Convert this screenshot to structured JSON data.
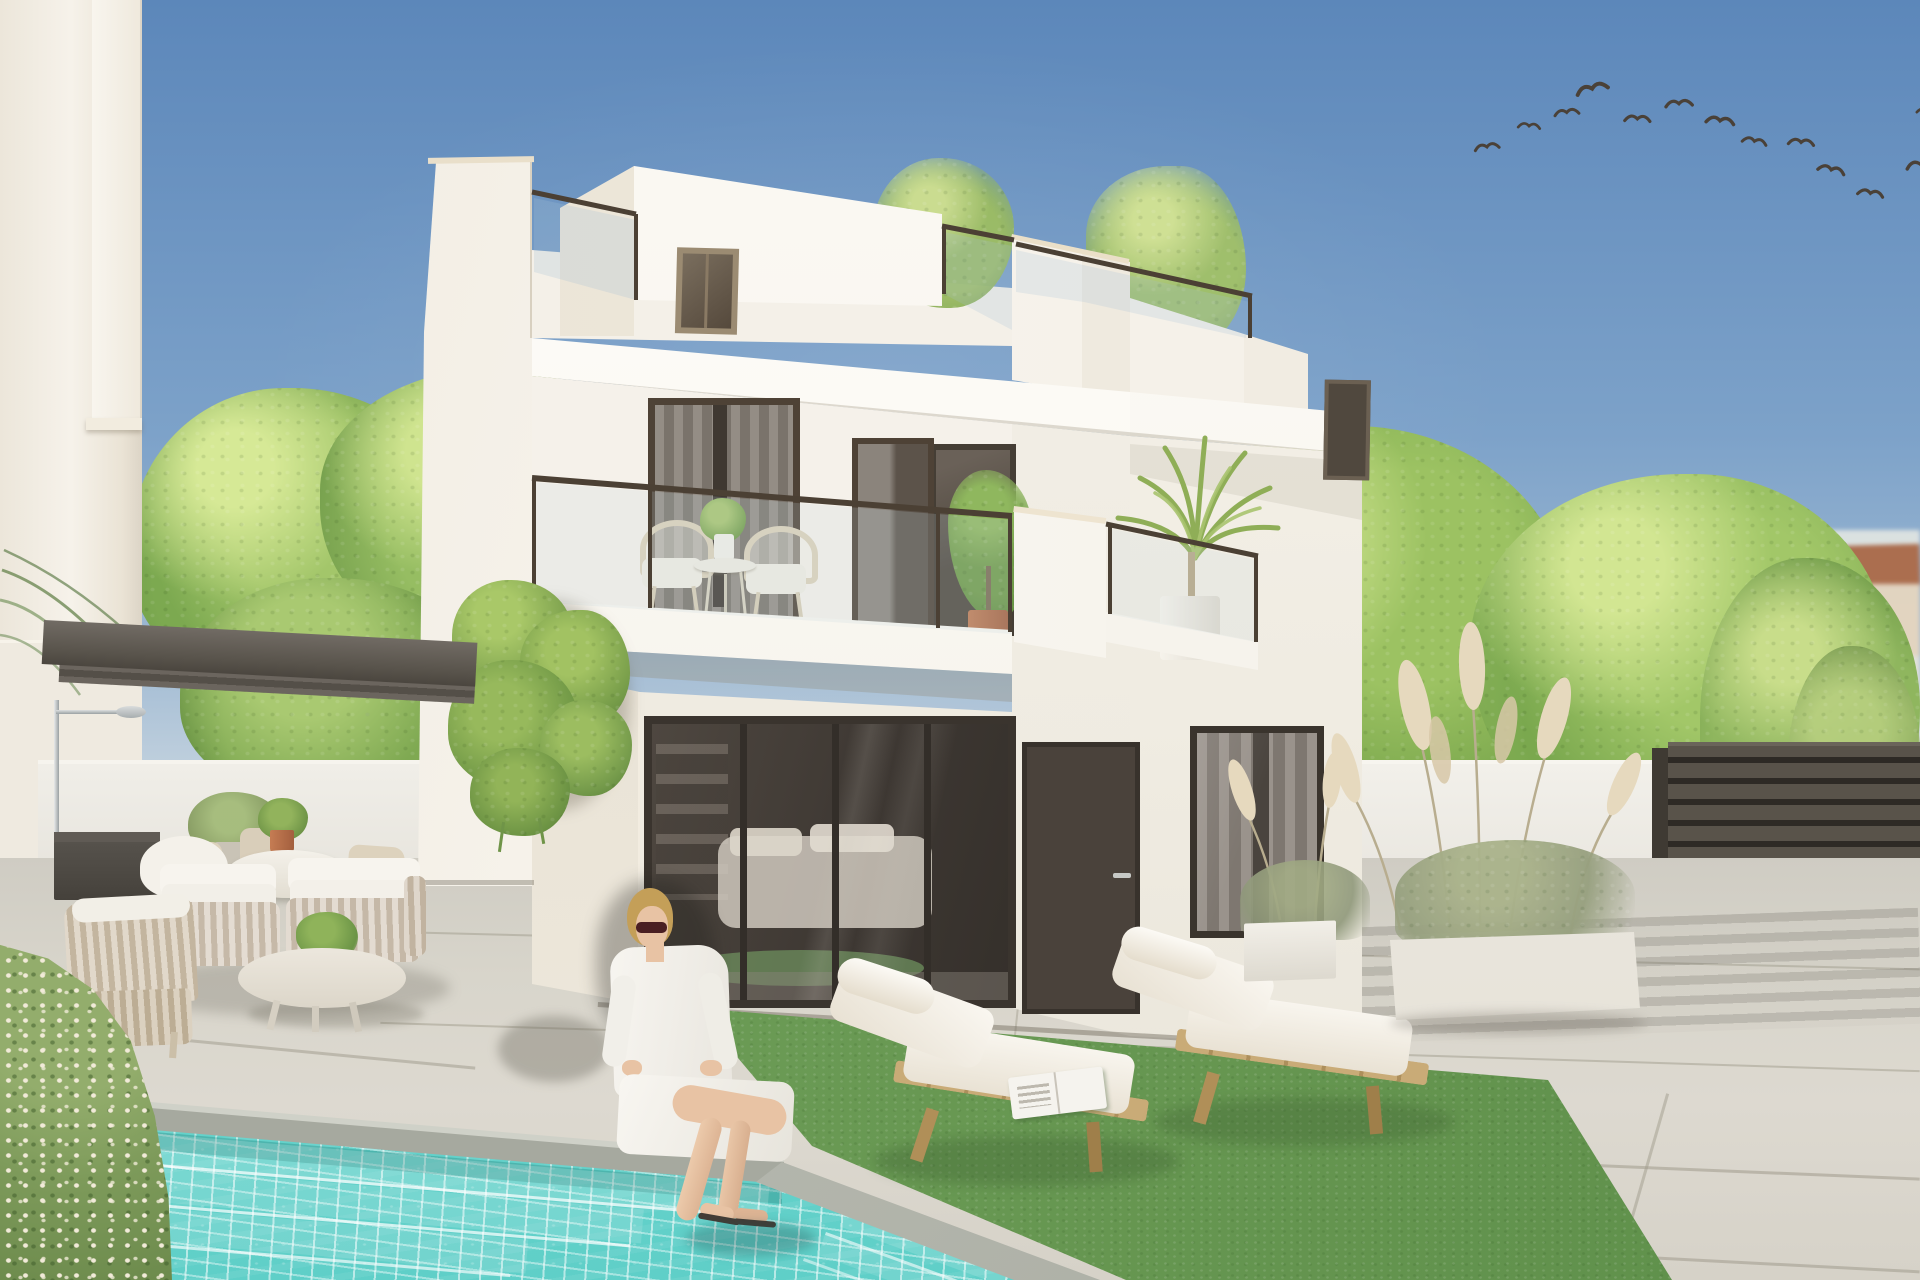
{
  "labels": {
    "scene": "Photorealistic exterior render: modern white three-level villa with rooftop terrace, two balconies with plants, large dark sliding glass doors, private turquoise mosaic pool with steps, woman in white seated on the pool edge, two wooden sun loungers on artificial grass, outdoor lounge and dining furniture under a dark pergola, white perimeter walls, pampas-grass planters, dark slatted gate, green trees, neighbouring rooftops and a flock of birds in a clear blue sky",
    "sky": "Clear blue sky",
    "birds": "Flock of birds flying top right",
    "villa": "White modern villa with flat roofs",
    "rooftop_terrace": "Rooftop terrace with dark glass railing and bamboo plants",
    "balcony_left": "First-floor balcony with two rattan chairs, round table and potted plants",
    "balcony_right": "First-floor balcony with palm in white planter",
    "ground_doors": "Dark-framed sliding glass doors and entrance door",
    "interior": "Interior living room glimpsed through glass",
    "pergola": "Dark grey pergola with outdoor shower",
    "lounge_set": "Rope-weave lounge armchairs with white cushions and oval coffee table",
    "dining_set": "Outdoor dining table with wicker chairs and terracotta plant pot",
    "pool": "Turquoise mosaic swimming pool with wide steps",
    "woman": "Woman in white shirt and sunglasses sitting on pool edge",
    "loungers": "Two wooden sun loungers with white cushions on artificial grass",
    "hedge": "Flowering hedge beside the pool",
    "fence": "Dark horizontal slatted gate",
    "planters": "White planters with pampas grass",
    "trees": "Green leafy trees",
    "neighbours": "Neighbouring houses with terracotta roofs"
  },
  "counts": {
    "birds": 13,
    "visible_levels": 3,
    "sun_loungers": 2,
    "balcony_chairs": 2,
    "lounge_armchairs": 3,
    "dining_chairs": 3,
    "sliding_glass_panels": 4,
    "pampas_planters": 2
  },
  "palette": {
    "sky_top": "#5c87ba",
    "sky_mid": "#7da2c9",
    "sky_horizon": "#cdd9e2",
    "wall_bright": "#faf7f1",
    "wall_cream": "#efe8db",
    "wall_shadow": "#e3dccd",
    "wall_grey": "#e9e6df",
    "frame_dark": "#3f3831",
    "glass_dark": "#49423b",
    "curtain_grey": "#8f8881",
    "railing_dark": "#4b4034",
    "pergola_dark": "#5e5851",
    "water": "#7cdcd4",
    "water_deep": "#5fcfc8",
    "grass_rug": "#6f9f58",
    "paving": "#d7d4ca",
    "coping_grey": "#a3a69d",
    "hedge_green": "#7d9a5a",
    "tree_green": "#7ea74f",
    "tree_dark": "#5d8a3c",
    "pampas_cream": "#e2d5ba",
    "planter_white": "#f1eee7",
    "wood": "#c9ab77",
    "cushion_white": "#f6f3ec",
    "fence_dark": "#4e4840",
    "terracotta": "#b4704d",
    "skin": "#e8c3a4",
    "hair_blonde": "#c49f58",
    "shirt_white": "#f4f2ed",
    "bird_dark": "#4a4138",
    "distant_roof": "#b06c4a"
  }
}
